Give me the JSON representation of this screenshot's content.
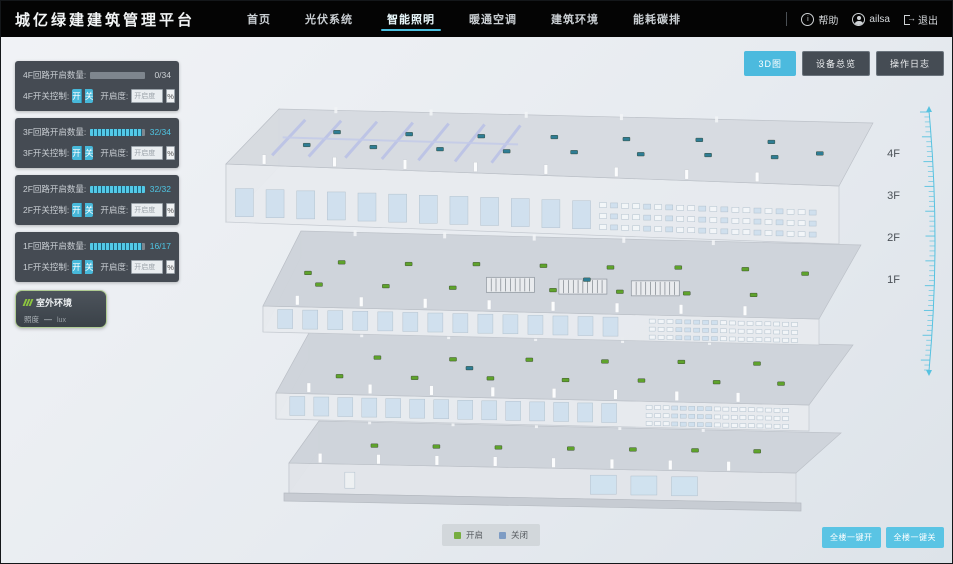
{
  "app": {
    "title": "城亿绿建建筑管理平台"
  },
  "nav": {
    "items": [
      {
        "label": "首页",
        "active": false
      },
      {
        "label": "光伏系统",
        "active": false
      },
      {
        "label": "智能照明",
        "active": true
      },
      {
        "label": "暖通空调",
        "active": false
      },
      {
        "label": "建筑环境",
        "active": false
      },
      {
        "label": "能耗碳排",
        "active": false
      }
    ]
  },
  "user_menu": {
    "help": "帮助",
    "username": "ailsa",
    "logout": "退出"
  },
  "view_toggle": [
    {
      "label": "3D图",
      "active": true
    },
    {
      "label": "设备总览",
      "active": false
    },
    {
      "label": "操作日志",
      "active": false
    }
  ],
  "floor_panels": [
    {
      "floor": "4F",
      "circuit_label": "4F回路开启数量:",
      "open_count": 0,
      "total_count": 34,
      "count_text": "0/34",
      "switch_label": "4F开关控制:",
      "on_label": "开",
      "off_label": "关",
      "dim_label": "开启度:",
      "dim_placeholder": "开启度",
      "percent_label": "%"
    },
    {
      "floor": "3F",
      "circuit_label": "3F回路开启数量:",
      "open_count": 32,
      "total_count": 34,
      "count_text": "32/34",
      "switch_label": "3F开关控制:",
      "on_label": "开",
      "off_label": "关",
      "dim_label": "开启度:",
      "dim_placeholder": "开启度",
      "percent_label": "%"
    },
    {
      "floor": "2F",
      "circuit_label": "2F回路开启数量:",
      "open_count": 32,
      "total_count": 32,
      "count_text": "32/32",
      "switch_label": "2F开关控制:",
      "on_label": "开",
      "off_label": "关",
      "dim_label": "开启度:",
      "dim_placeholder": "开启度",
      "percent_label": "%"
    },
    {
      "floor": "1F",
      "circuit_label": "1F回路开启数量:",
      "open_count": 16,
      "total_count": 17,
      "count_text": "16/17",
      "switch_label": "1F开关控制:",
      "on_label": "开",
      "off_label": "关",
      "dim_label": "开启度:",
      "dim_placeholder": "开启度",
      "percent_label": "%"
    }
  ],
  "outdoor_panel": {
    "title": "室外环境",
    "metric_label": "照度",
    "metric_value": "—",
    "metric_unit": "lux"
  },
  "floor_axis_labels": [
    "4F",
    "3F",
    "2F",
    "1F"
  ],
  "legend": {
    "items": [
      {
        "label": "开启",
        "color": "#76ad3f"
      },
      {
        "label": "关闭",
        "color": "#7e9cc4"
      }
    ]
  },
  "bulk_actions": [
    {
      "label": "全楼一键开"
    },
    {
      "label": "全楼一键关"
    }
  ],
  "colors": {
    "accent": "#49bede",
    "nav_bg": "#040404",
    "panel_bg": "#3a4148",
    "marker_open": "#5fa32c",
    "marker_closed": "#2e7d95"
  }
}
